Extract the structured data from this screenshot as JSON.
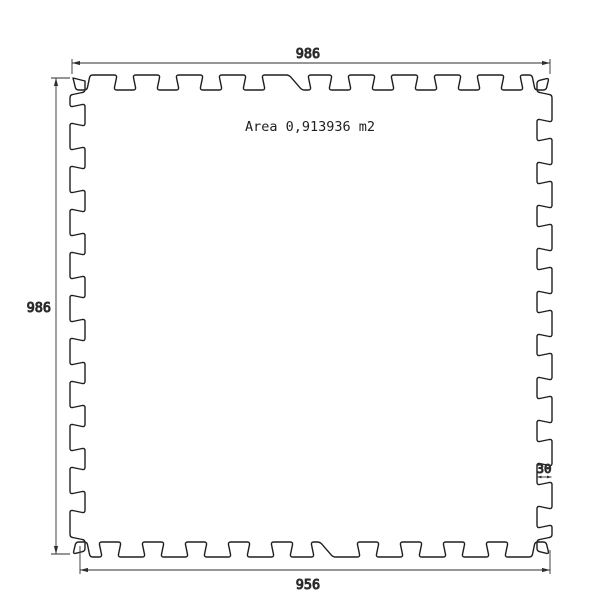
{
  "drawing": {
    "area_label": "Area 0,913936 m2",
    "dimensions": {
      "top": "986",
      "left": "986",
      "bottom": "956",
      "tab": "30"
    },
    "colors": {
      "outline": "#1f1f1f",
      "dimension": "#2e2e2e",
      "text": "#1f1f1f",
      "background": "#ffffff"
    }
  }
}
